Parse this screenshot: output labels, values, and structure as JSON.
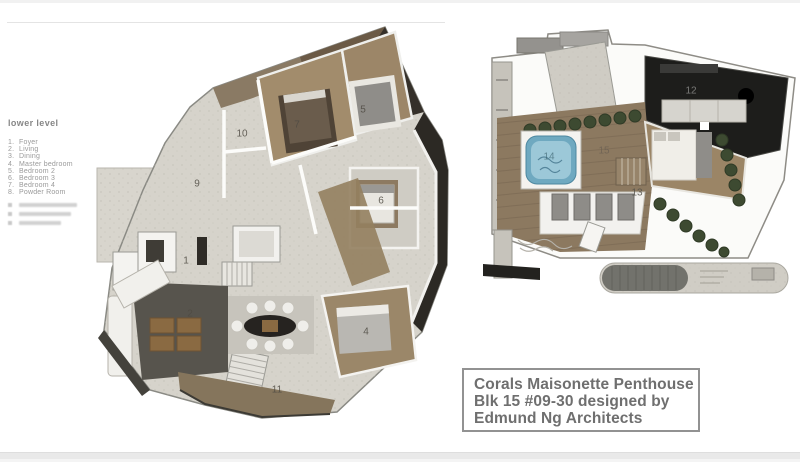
{
  "legend": {
    "title": "lower level",
    "items": [
      {
        "number": "1.",
        "label": "Foyer"
      },
      {
        "number": "2.",
        "label": "Living"
      },
      {
        "number": "3.",
        "label": "Dining"
      },
      {
        "number": "4.",
        "label": "Master bedroom"
      },
      {
        "number": "5.",
        "label": "Bedroom 2"
      },
      {
        "number": "6.",
        "label": "Bedroom 3"
      },
      {
        "number": "7.",
        "label": "Bedroom 4"
      },
      {
        "number": "8.",
        "label": "Powder Room"
      }
    ],
    "illegible_rows": 3
  },
  "plans": {
    "lower": {
      "label": "lower level floor plan",
      "room_numbers": [
        {
          "id": "1",
          "x": 186,
          "y": 261
        },
        {
          "id": "2",
          "x": 190,
          "y": 314
        },
        {
          "id": "4",
          "x": 366,
          "y": 332
        },
        {
          "id": "5",
          "x": 363,
          "y": 110
        },
        {
          "id": "6",
          "x": 381,
          "y": 201
        },
        {
          "id": "7",
          "x": 297,
          "y": 125
        },
        {
          "id": "9",
          "x": 197,
          "y": 184
        },
        {
          "id": "10",
          "x": 242,
          "y": 134
        },
        {
          "id": "11",
          "x": 277,
          "y": 390
        }
      ]
    },
    "upper": {
      "label": "upper level floor plan",
      "room_numbers": [
        {
          "id": "12",
          "x": 691,
          "y": 91,
          "color": "#8a8a88"
        },
        {
          "id": "13",
          "x": 637,
          "y": 193,
          "color": "#55524b"
        },
        {
          "id": "14",
          "x": 549,
          "y": 157,
          "color": "#3f6673",
          "opacity": 0.7
        },
        {
          "id": "15",
          "x": 604,
          "y": 151,
          "color": "#6e6254"
        }
      ]
    }
  },
  "title_box": {
    "lines": [
      "Corals Maisonette Penthouse",
      "Blk 15 #09-30 designed by",
      "Edmund Ng Architects"
    ]
  },
  "colors": {
    "stone": "#d6d3cb",
    "wood": "#9c8668",
    "wood_dark": "#6b5a46",
    "deck": "#8c7960",
    "dark_room": "#1e1e1c",
    "hedge": "#3d4a31",
    "jacuzzi": "#6fa9c0",
    "text_gray": "#6f6f6f",
    "legend_gray": "#9a9a9a"
  }
}
